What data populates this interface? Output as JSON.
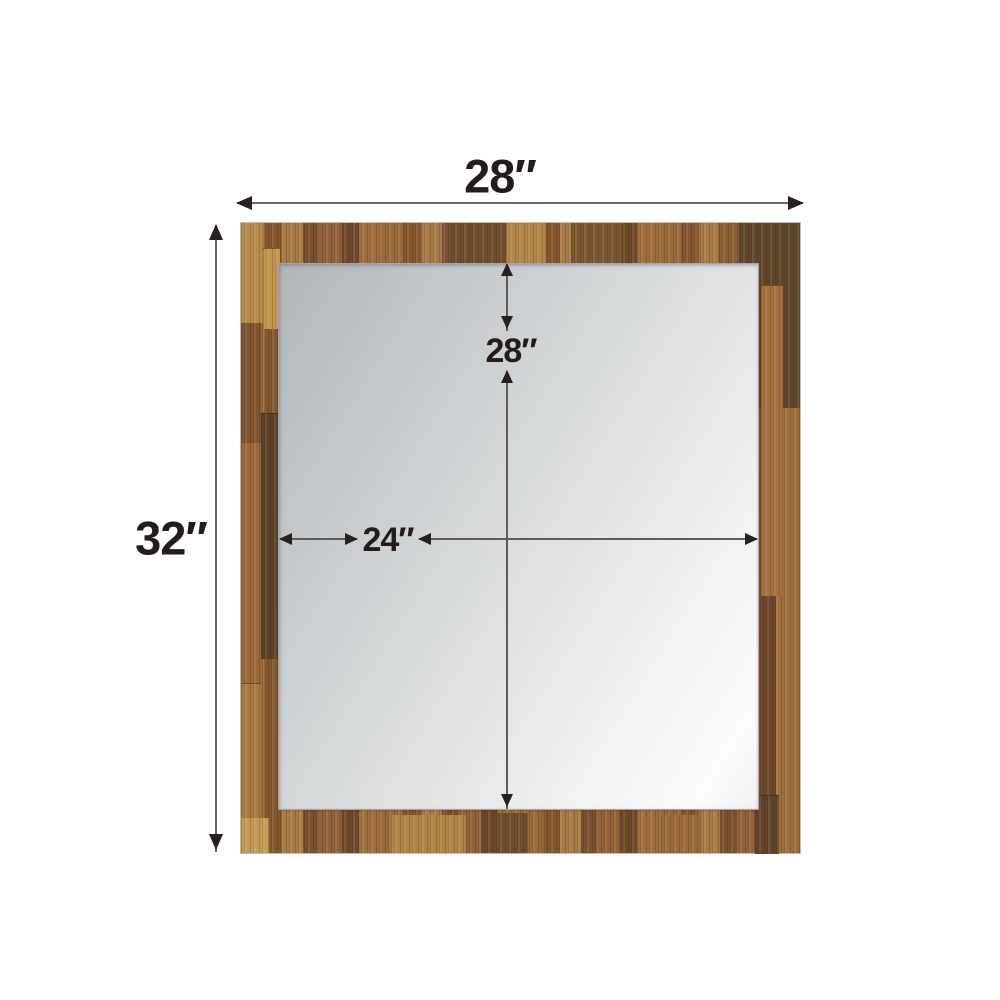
{
  "diagram": {
    "subject": "framed-mirror-dimension-diagram",
    "labels": {
      "overall_width": "28″",
      "overall_height": "32″",
      "mirror_height": "28″",
      "mirror_width": "24″"
    },
    "colors": {
      "background": "#ffffff",
      "wood_base": "#8a5c33",
      "wood_dark": "#5d4128",
      "wood_light": "#c0914c",
      "mirror_shade": "#b2b6b9",
      "mirror_light": "#fbfbfb",
      "dimension_line": "#5f5b59",
      "arrowhead": "#27201d",
      "dimension_text": "#241c1a"
    }
  }
}
